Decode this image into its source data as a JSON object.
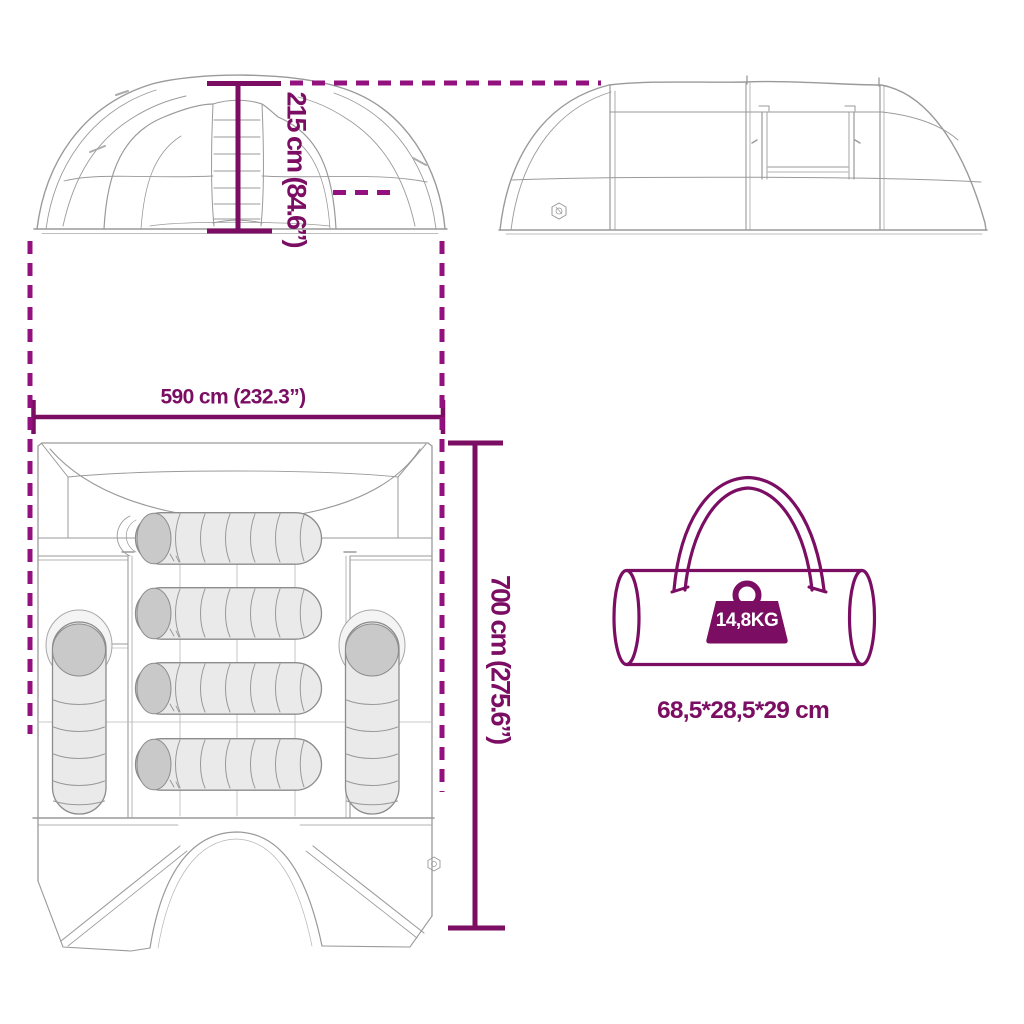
{
  "colors": {
    "accent": "#7B0E63",
    "accent_dash": "#93117E",
    "sketch_line": "#9A9A9A",
    "bag_fill": "#EAEAEA",
    "bag_shade": "#C9C9C9",
    "weight_text": "#FFFFFF"
  },
  "labels": {
    "height": "215 cm (84.6”)",
    "width": "590 cm (232.3”)",
    "depth": "700 cm (275.6”)",
    "weight": "14,8KG",
    "bag_size": "68,5*28,5*29 cm"
  },
  "icons": {
    "brand_logo": "hexagon-brand-logo",
    "weight": "kettlebell-weight-icon"
  },
  "views": {
    "front_view": "tent front elevation with height dimension",
    "side_view": "tent side elevation",
    "top_view": "tent floor plan with six sleeping bags",
    "carry_bag": "packed tent carry bag with weight and pack size"
  }
}
